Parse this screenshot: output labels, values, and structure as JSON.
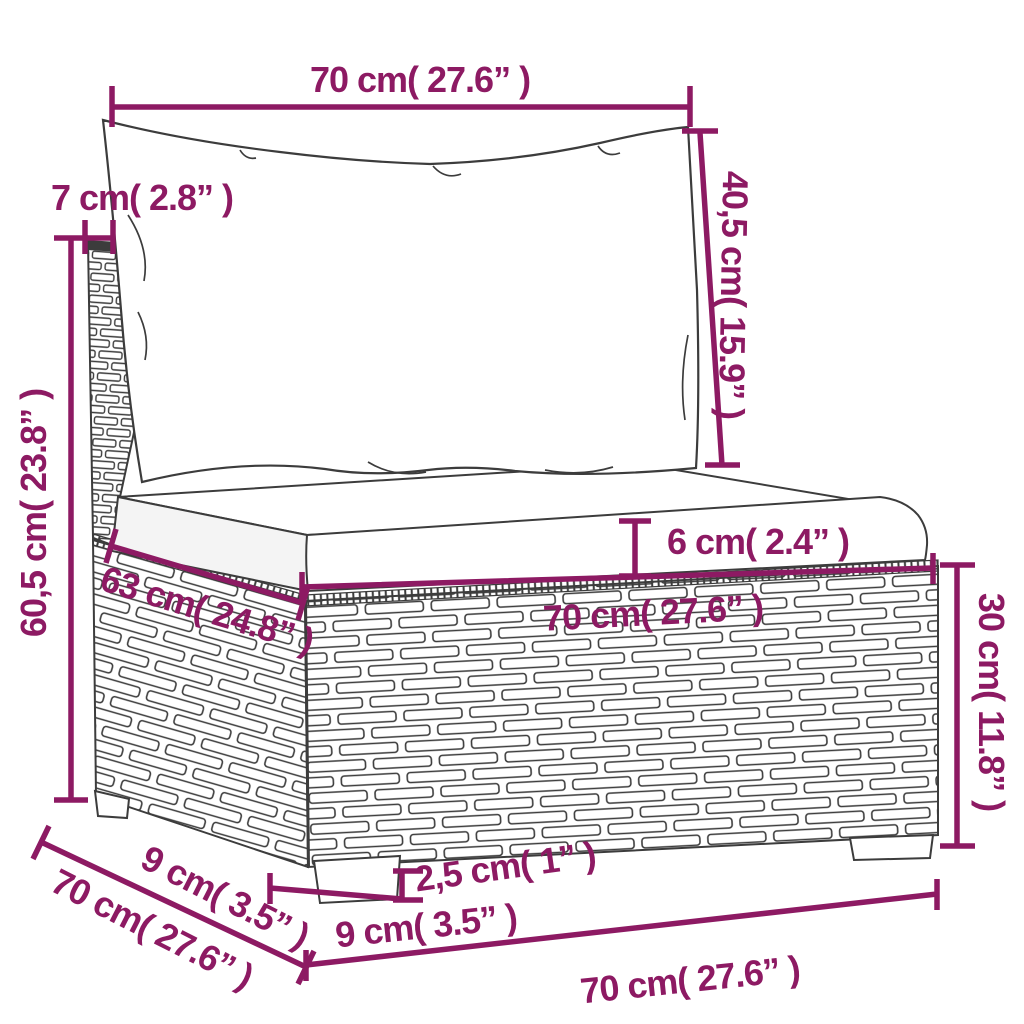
{
  "diagram": {
    "title": "Rattan garden sofa middle section with cushions — dimension drawing",
    "accent_color": "#8D1A63",
    "outline_color": "#3c3c3c",
    "dimensions": [
      {
        "id": "back-cushion-width",
        "label": "70 cm( 27.6” )"
      },
      {
        "id": "back-frame-depth",
        "label": "7 cm( 2.8” )"
      },
      {
        "id": "back-cushion-height",
        "label": "40,5 cm( 15.9” )"
      },
      {
        "id": "total-height",
        "label": "60,5 cm( 23.8” )"
      },
      {
        "id": "seat-cushion-thickness",
        "label": "6 cm( 2.4” )"
      },
      {
        "id": "seat-depth",
        "label": "63 cm( 24.8” )"
      },
      {
        "id": "seat-width",
        "label": "70 cm( 27.6” )"
      },
      {
        "id": "base-height",
        "label": "30 cm( 11.8” )"
      },
      {
        "id": "leg-depth",
        "label": "9 cm( 3.5” )"
      },
      {
        "id": "total-depth",
        "label": "70 cm( 27.6” )"
      },
      {
        "id": "leg-height",
        "label": "2,5 cm( 1” )"
      },
      {
        "id": "leg-width",
        "label": "9 cm( 3.5” )"
      },
      {
        "id": "base-width",
        "label": "70 cm( 27.6” )"
      }
    ]
  }
}
